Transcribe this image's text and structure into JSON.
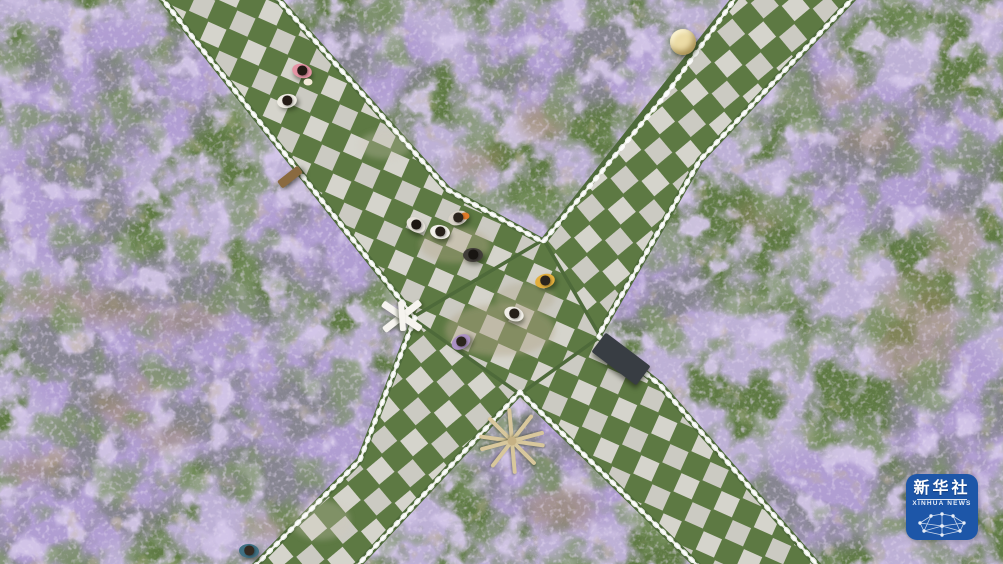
{
  "meta": {
    "description": "Aerial photo: visitors stroll on X-shaped checkerboard stone walkways crossing a purple verbena flower field"
  },
  "watermark": {
    "cn": "新华社",
    "en": "XINHUA NEWS",
    "bg": "#1d56a8"
  },
  "scene": {
    "palette": {
      "flower_purple": "#8b74ba",
      "flower_light_purple": "#a993d1",
      "field_green": "#5f7a44",
      "stone_gray": "#cbcac2",
      "railing_white": "#f4f4ef",
      "dirt_tan": "#a3927a",
      "logo_blue": "#1d56a8"
    },
    "people": [
      {
        "x": 302,
        "y": 71,
        "body": "#e493a4",
        "hair": "#231a14",
        "rot": 15,
        "acc": "#f3ead8",
        "accx": 6,
        "accy": 11
      },
      {
        "x": 287,
        "y": 101,
        "body": "#efece4",
        "hair": "#241c16",
        "rot": -10
      },
      {
        "x": 416,
        "y": 225,
        "body": "#e6e2da",
        "hair": "#1c1612",
        "rot": 30
      },
      {
        "x": 440,
        "y": 232,
        "body": "#f3f1eb",
        "hair": "#262019",
        "rot": 10
      },
      {
        "x": 458,
        "y": 218,
        "body": "#d9d3c9",
        "hair": "#2b241d",
        "rot": -20,
        "acc": "#e07a28",
        "accx": 7,
        "accy": -2
      },
      {
        "x": 473,
        "y": 255,
        "body": "#413d39",
        "hair": "#191512",
        "rot": 0
      },
      {
        "x": 545,
        "y": 281,
        "body": "#e2ae3c",
        "hair": "#2b241d",
        "rot": -15
      },
      {
        "x": 514,
        "y": 314,
        "body": "#f1eee7",
        "hair": "#251f18",
        "rot": 20
      },
      {
        "x": 461,
        "y": 342,
        "body": "#ab90c4",
        "hair": "#2b241d",
        "rot": -30
      },
      {
        "x": 249,
        "y": 551,
        "body": "#3f7083",
        "hair": "#332a22",
        "rot": 5
      }
    ],
    "objects": [
      {
        "type": "straw-hat",
        "x": 683,
        "y": 42,
        "d": 26,
        "color": "#ecdca6"
      },
      {
        "type": "bench-small",
        "x": 290,
        "y": 177,
        "w": 26,
        "h": 9,
        "rot": -38,
        "color": "#8a6a40"
      },
      {
        "type": "white-chair",
        "x": 402,
        "y": 316,
        "color": "#f6f4ef"
      },
      {
        "type": "bench-dark",
        "x": 621,
        "y": 359,
        "w": 56,
        "h": 24,
        "rot": 37,
        "color": "#383d43"
      },
      {
        "type": "wood-rack",
        "x": 512,
        "y": 441,
        "color": "#d8c79c",
        "hub": "#c6b184",
        "spokes": [
          8,
          45,
          85,
          128,
          165
        ],
        "len": 66
      }
    ]
  }
}
